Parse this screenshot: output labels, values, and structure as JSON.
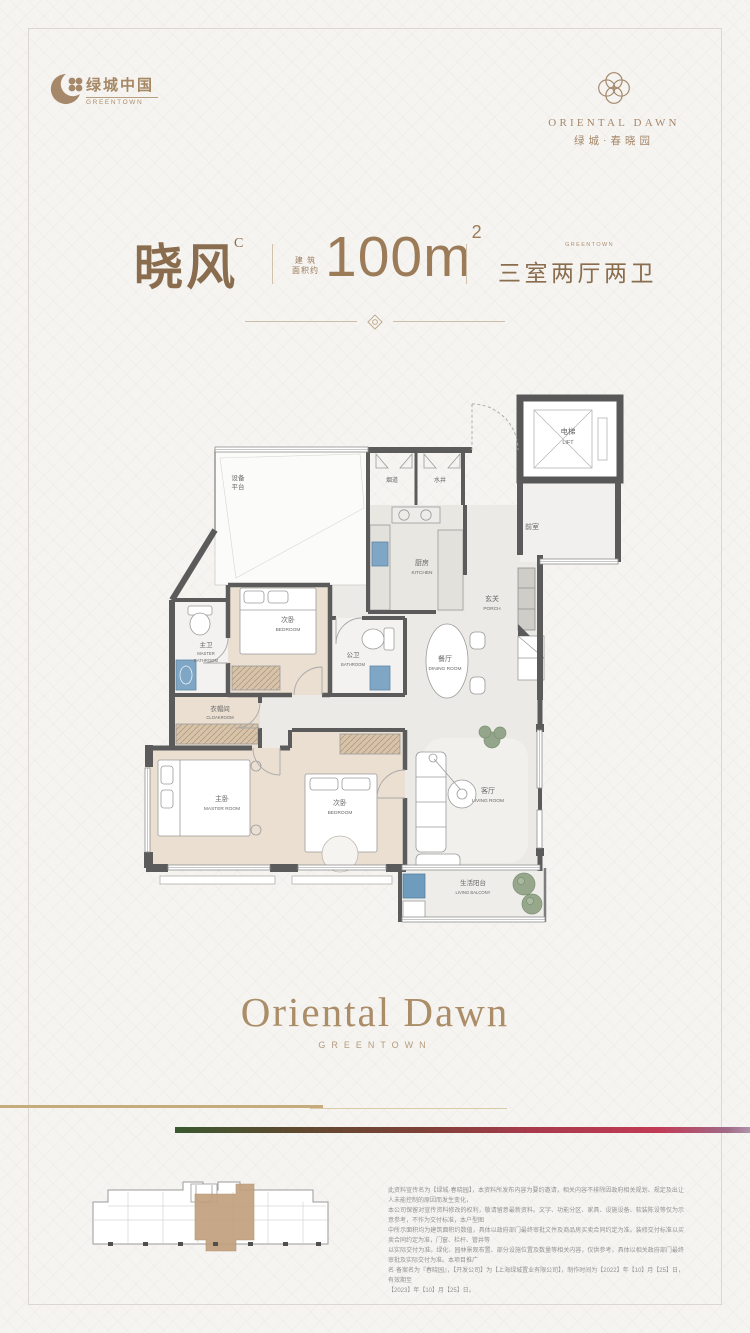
{
  "brand": {
    "greentown_cn": "绿城中国",
    "greentown_en": "GREENTOWN",
    "project_en": "ORIENTAL DAWN",
    "project_cn": "绿城·春晓园"
  },
  "title": {
    "unit_name": "晓风",
    "unit_code": "C",
    "area_prefix_line1": "建 筑",
    "area_prefix_line2": "面积约",
    "area_value": "100m",
    "area_sup": "2",
    "brand_small": "GREENTOWN",
    "layout": "三室两厅两卫"
  },
  "floorplan": {
    "rooms": {
      "equipment": {
        "line1": "设备",
        "line2": "平台"
      },
      "flue": {
        "cn": "烟道"
      },
      "water": {
        "cn": "水井"
      },
      "lift": {
        "cn": "电梯",
        "en": "LIFT"
      },
      "lobby": {
        "cn": "前室"
      },
      "kitchen": {
        "cn": "厨房",
        "en": "KITCHEN"
      },
      "porch": {
        "cn": "玄关",
        "en": "PORCH"
      },
      "bedroom2": {
        "cn": "次卧",
        "en": "BEDROOM"
      },
      "master_bath": {
        "cn": "主卫",
        "en1": "MASTER",
        "en2": "BATHROOM"
      },
      "bath": {
        "cn": "公卫",
        "en": "BATHROOM"
      },
      "dining": {
        "cn": "餐厅",
        "en": "DINING ROOM"
      },
      "cloakroom": {
        "cn": "衣帽间",
        "en": "CLOAKROOM"
      },
      "master": {
        "cn": "主卧",
        "en": "MASTER ROOM"
      },
      "bedroom3": {
        "cn": "次卧",
        "en": "BEDROOM"
      },
      "living": {
        "cn": "客厅",
        "en": "LIVING ROOM"
      },
      "balcony": {
        "cn": "生活阳台",
        "en": "LIVING BALCONY"
      }
    }
  },
  "footer": {
    "wordmark": "Oriental Dawn",
    "wordmark_sub": "GREENTOWN",
    "disclaimer_lines": [
      "此资料宣传名为【绿城·春晓园】，本资料所发布内容为要约邀请，相关内容不排除因政府相关规划、规定及出让人未能控制的原因而发生变化，",
      "本公司保留对宣传资料修改的权利，敬请留意最新资料。文字、功能分区、家具、设施设备、软装陈设等仅为示意参考，不作为交付标准，本户型图",
      "中所示面积均为建筑面积约数值，具体以政府部门最终审批文件及商品房买卖合同约定为准。装修交付标准以买卖合同约定为准，门窗、栏杆、管井等",
      "以实际交付为准。绿化、园林景观布置、部分设施位置及数量等相关内容，仅供参考，具体以相关政府部门最终审批及实际交付为准。本项目推广",
      "名·备案名为『春晓园』，【开发公司】为【上海绿城置业有限公司】，制作时间为【2022】年【10】月【25】日，有效期至",
      "【2023】年【10】月【25】日。"
    ]
  },
  "colors": {
    "brand_brown": "#8a6c4e",
    "bronze": "#9c7c58",
    "wordmark": "#ab8d68",
    "wall_gray": "#5b5b5b",
    "floor_tan": "#eadfd1",
    "sink_blue": "#7fa7c5",
    "plant_green": "#93a68b",
    "keyplan_highlight": "#c2a07e",
    "gradient_bar": [
      "#39582e",
      "#7c4136",
      "#c23a55",
      "#b193ab"
    ],
    "gold_line": "#c6ab7c"
  }
}
